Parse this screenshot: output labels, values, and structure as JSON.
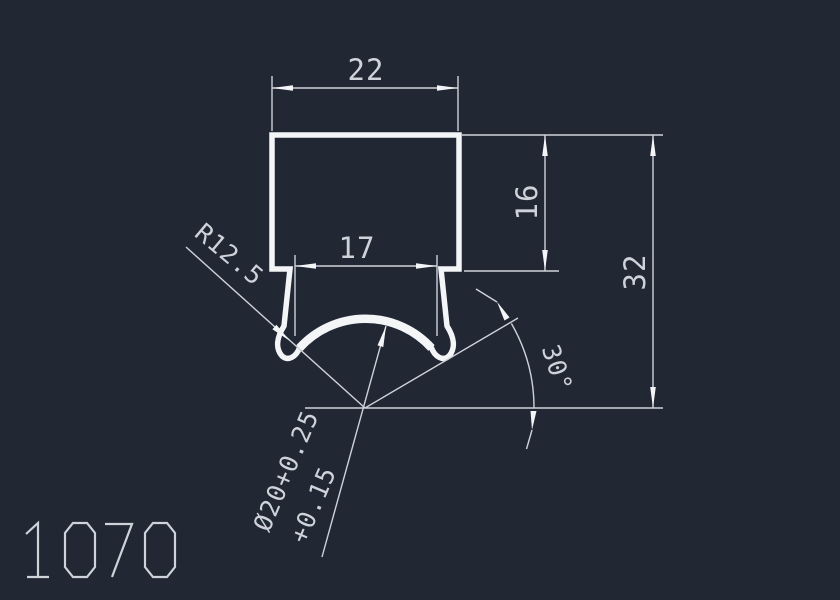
{
  "drawing": {
    "part_number": "1070",
    "dimensions": {
      "width_top": "22",
      "width_inner": "17",
      "height_upper": "16",
      "height_total": "32",
      "radius_label": "R12.5",
      "diameter_line1": "Ø20+0.25",
      "diameter_line2": "+0.15",
      "angle_label": "30°"
    }
  },
  "colors": {
    "background": "#212733",
    "profile_line": "#f4f5f7",
    "dimension_line": "#cfd3d9",
    "text": "#ced3da"
  }
}
